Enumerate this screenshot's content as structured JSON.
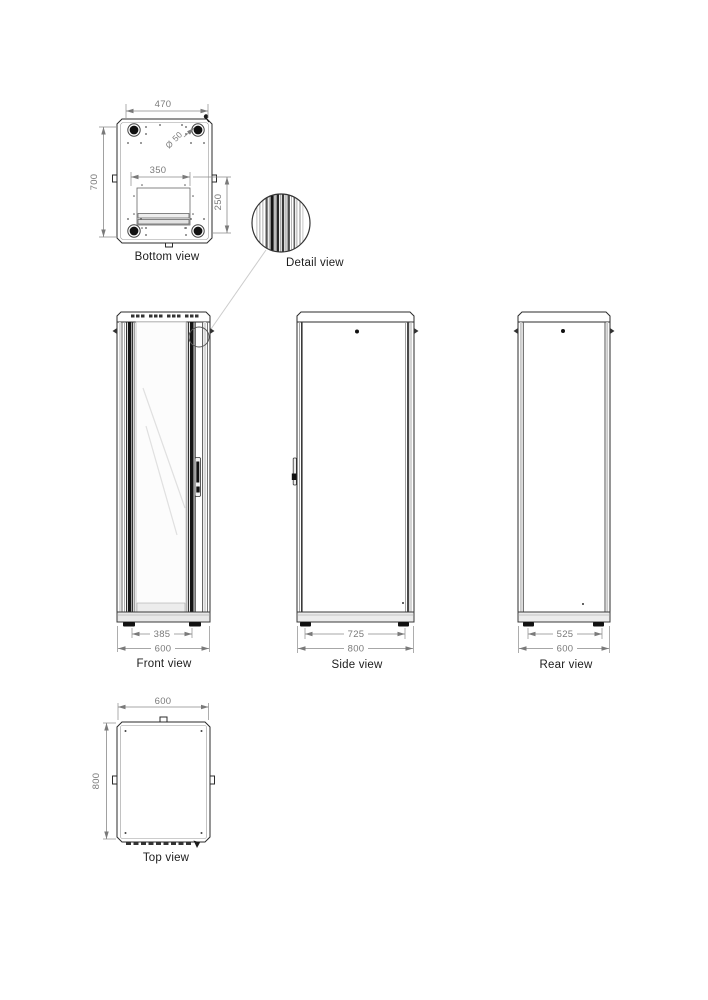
{
  "views": {
    "bottom": {
      "label": "Bottom view",
      "dims": {
        "overall_width": "470",
        "overall_depth": "700",
        "cutout_width": "350",
        "cutout_depth": "250",
        "hole_diameter": "Ø 50"
      }
    },
    "detail": {
      "label": "Detail view"
    },
    "front": {
      "label": "Front view",
      "dims": {
        "inner_width": "385",
        "overall_width": "600"
      }
    },
    "side": {
      "label": "Side view",
      "dims": {
        "inner_depth": "725",
        "overall_depth": "800"
      }
    },
    "rear": {
      "label": "Rear view",
      "dims": {
        "inner_width": "525",
        "overall_width": "600"
      }
    },
    "top": {
      "label": "Top view",
      "dims": {
        "overall_width": "600",
        "overall_depth": "800"
      }
    }
  },
  "colors": {
    "line": "#2b2b2b",
    "dimension": "#7a7a7a",
    "label": "#1c1c1c",
    "background": "#ffffff"
  }
}
